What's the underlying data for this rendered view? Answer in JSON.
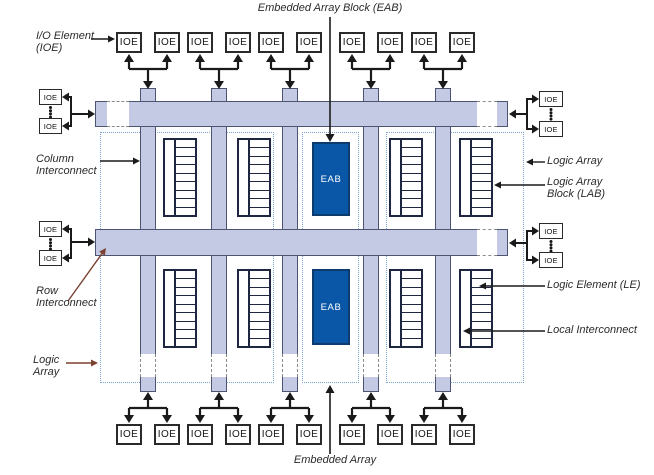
{
  "figure": {
    "top_caption": "Embedded Array Block (EAB)",
    "bottom_caption": "Embedded Array",
    "ioe_box_label": "IOE",
    "eab_box_label": "EAB",
    "side_labels": {
      "io_element": {
        "line1": "I/O Element",
        "line2": "(IOE)"
      },
      "column_interconnect": {
        "line1": "Column",
        "line2": "Interconnect"
      },
      "row_interconnect": {
        "line1": "Row",
        "line2": "Interconnect"
      },
      "logic_array_left": {
        "line1": "Logic",
        "line2": "Array"
      },
      "logic_array_right": {
        "line1": "Logic Array"
      },
      "logic_array_block": {
        "line1": "Logic Array",
        "line2": "Block (LAB)"
      },
      "logic_element": {
        "line1": "Logic Element (LE)"
      },
      "local_interconnect": {
        "line1": "Local Interconnect"
      }
    },
    "counts": {
      "ioe_top_row": 10,
      "ioe_bottom_row": 10,
      "ioe_left_groups": 2,
      "ioe_right_groups": 2,
      "row_interconnects": 2,
      "column_interconnects": 5,
      "lab_blocks": 8,
      "eab_blocks": 2,
      "logic_elements_per_lab": 9
    },
    "colors": {
      "background": "#ffffff",
      "interconnect_fill": "#c5cae4",
      "interconnect_border": "#4d5473",
      "eab_fill": "#0b57a7",
      "eab_border": "#0c3c6e",
      "eab_text": "#ffffff",
      "dotted_outline": "#79a3d1",
      "break_dash": "#8a8a8a",
      "arrow_black": "#1a1a1a",
      "arrow_brown": "#7b4231",
      "label_text": "#2b2b2b"
    }
  }
}
